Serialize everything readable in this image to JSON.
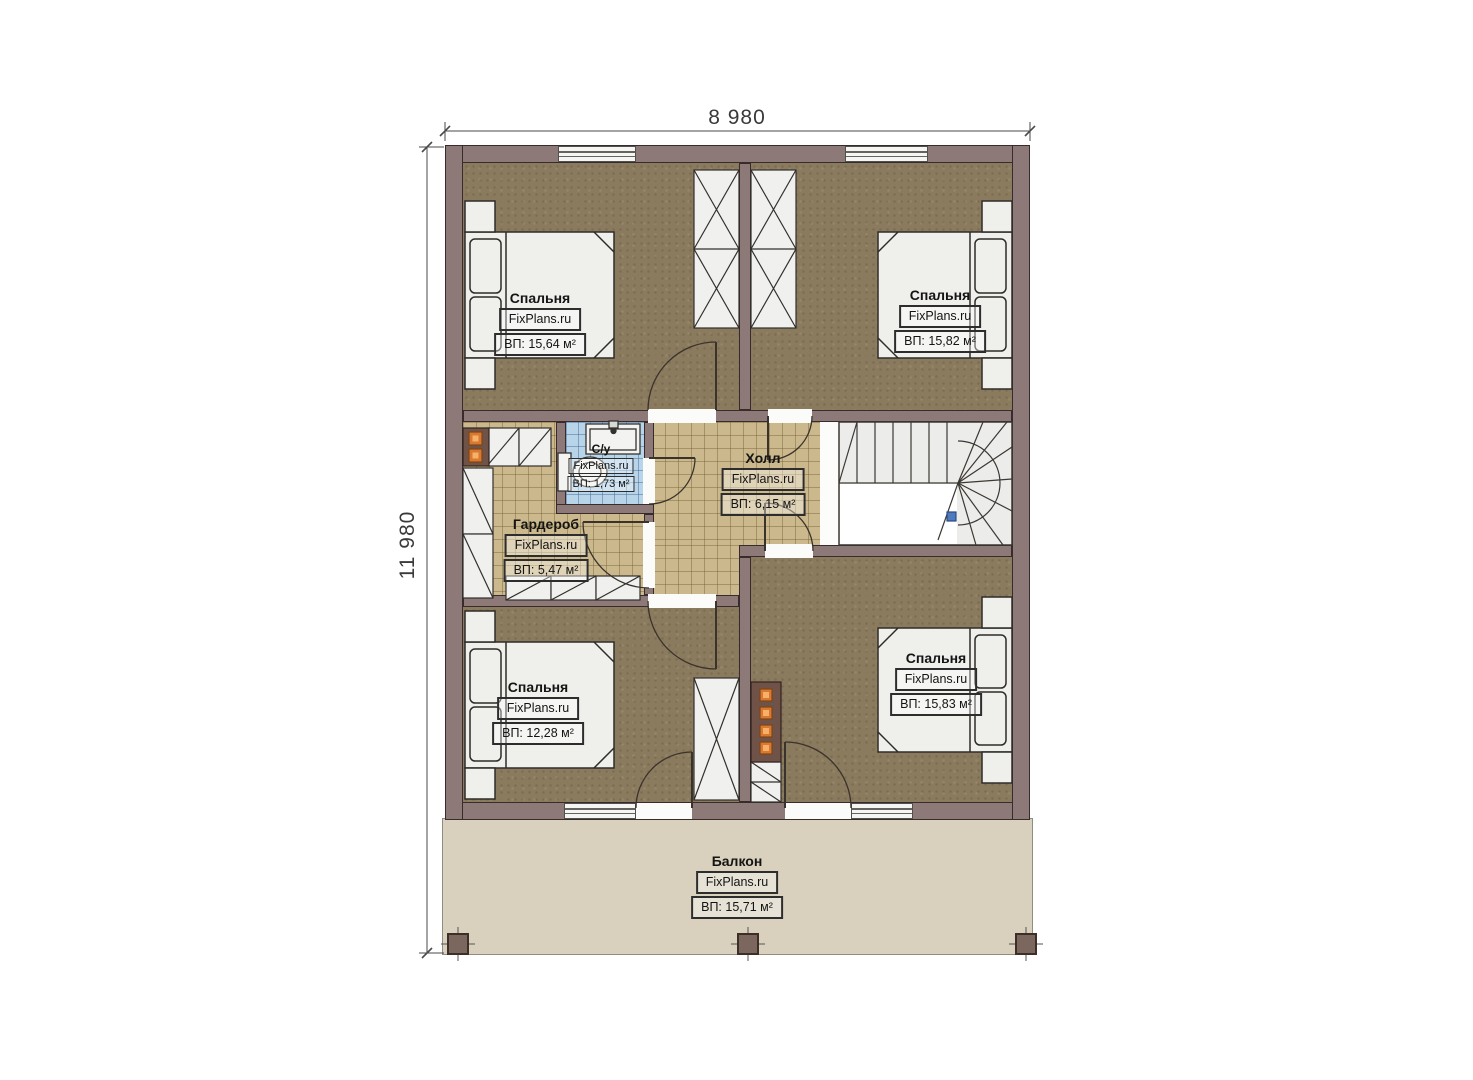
{
  "plan_title": "floor-plan-second-level",
  "dimensions": {
    "top": "8 980",
    "left": "11 980"
  },
  "watermark": "FixPlans.ru",
  "rooms": {
    "bedroom_top_left": {
      "name": "Спальня",
      "area": "ВП: 15,64 м²"
    },
    "bedroom_top_right": {
      "name": "Спальня",
      "area": "ВП: 15,82 м²"
    },
    "bathroom": {
      "name": "С/у",
      "area": "ВП: 1,73 м²"
    },
    "wardrobe": {
      "name": "Гардероб",
      "area": "ВП: 5,47 м²"
    },
    "hall": {
      "name": "Холл",
      "area": "ВП: 6,15 м²"
    },
    "bedroom_bottom_left": {
      "name": "Спальня",
      "area": "ВП: 12,28 м²"
    },
    "bedroom_bottom_right": {
      "name": "Спальня",
      "area": "ВП: 15,83 м²"
    },
    "balcony": {
      "name": "Балкон",
      "area": "ВП: 15,71 м²"
    }
  },
  "colors": {
    "wall": "#8e7979",
    "wall_outline": "#372b2b",
    "bedroom_floor": "#8a7a5e",
    "tile_floor": "#cbb98d",
    "bath_floor": "#b7d4e9",
    "balcony_floor": "#d9d0bd",
    "furniture": "#efefec",
    "flue_orange": "#d8792f",
    "stair_marker_blue": "#4f79bd"
  }
}
